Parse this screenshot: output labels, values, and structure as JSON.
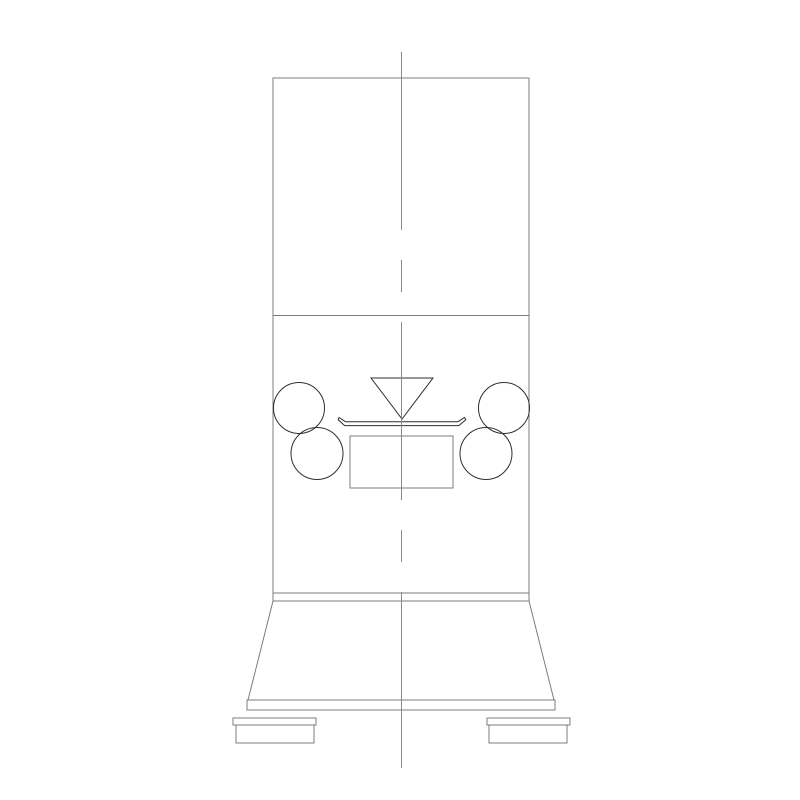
{
  "canvas": {
    "width": 800,
    "height": 800,
    "background": "#ffffff"
  },
  "colors": {
    "outline": "#7c7c7c",
    "detail": "#2f2f2f",
    "centerline": "#8a8a8a"
  },
  "drawing": {
    "description": "Front-view CAD line drawing of a floor-standing machine: tall rectangular body, hopper funnel, four rollers, front panel, tapered base skirt, base plate and two feet; vertical dash-dot centerline.",
    "centerline": {
      "x": 401.5,
      "y1": 52,
      "y2": 768,
      "dash": "178 30 32 30"
    },
    "shapes": [
      {
        "type": "rect",
        "name": "machine-body",
        "x": 273,
        "y": 78,
        "w": 256,
        "h": 515,
        "stroke": "outline",
        "crisp": true
      },
      {
        "type": "line",
        "name": "body-section-divider",
        "x1": 273,
        "y1": 315.5,
        "x2": 529,
        "y2": 315.5,
        "stroke": "outline",
        "crisp": true
      },
      {
        "type": "rect",
        "name": "base-collar-band",
        "x": 273,
        "y": 593,
        "w": 256,
        "h": 8,
        "stroke": "outline",
        "crisp": true
      },
      {
        "type": "polygon",
        "name": "base-skirt",
        "points": "273,601 529,601 554,700 248,700",
        "stroke": "outline"
      },
      {
        "type": "rect",
        "name": "base-plate",
        "x": 247,
        "y": 700,
        "w": 308,
        "h": 10,
        "stroke": "outline",
        "crisp": true
      },
      {
        "type": "rect",
        "name": "left-foot-flange",
        "x": 233,
        "y": 718,
        "w": 83,
        "h": 7,
        "stroke": "outline",
        "crisp": true
      },
      {
        "type": "rect",
        "name": "left-foot-block",
        "x": 236,
        "y": 725,
        "w": 78,
        "h": 18,
        "stroke": "outline",
        "crisp": true
      },
      {
        "type": "rect",
        "name": "right-foot-flange",
        "x": 487,
        "y": 718,
        "w": 83,
        "h": 7,
        "stroke": "outline",
        "crisp": true
      },
      {
        "type": "rect",
        "name": "right-foot-block",
        "x": 489,
        "y": 725,
        "w": 78,
        "h": 18,
        "stroke": "outline",
        "crisp": true
      },
      {
        "type": "circle",
        "name": "roller-upper-left",
        "cx": 299,
        "cy": 408,
        "r": 25.5,
        "stroke": "detail"
      },
      {
        "type": "circle",
        "name": "roller-lower-left",
        "cx": 317,
        "cy": 453.5,
        "r": 26,
        "stroke": "detail"
      },
      {
        "type": "circle",
        "name": "roller-upper-right",
        "cx": 504,
        "cy": 408,
        "r": 25.5,
        "stroke": "detail"
      },
      {
        "type": "circle",
        "name": "roller-lower-right",
        "cx": 486,
        "cy": 453.5,
        "r": 26,
        "stroke": "detail"
      },
      {
        "type": "polygon",
        "name": "hopper-funnel",
        "points": "371,378 433,378 402,419",
        "stroke": "detail"
      },
      {
        "type": "path",
        "name": "spreader-tray",
        "d": "M339,417.5 L345.5,421.7 L458,421.7 L464.5,417.5 L465.8,419.8 L458.8,425.6 L344.7,425.6 L338.2,419.8 Z",
        "stroke": "detail"
      },
      {
        "type": "rect",
        "name": "front-panel",
        "x": 350,
        "y": 436,
        "w": 103,
        "h": 52,
        "stroke": "outline",
        "crisp": true
      }
    ]
  }
}
